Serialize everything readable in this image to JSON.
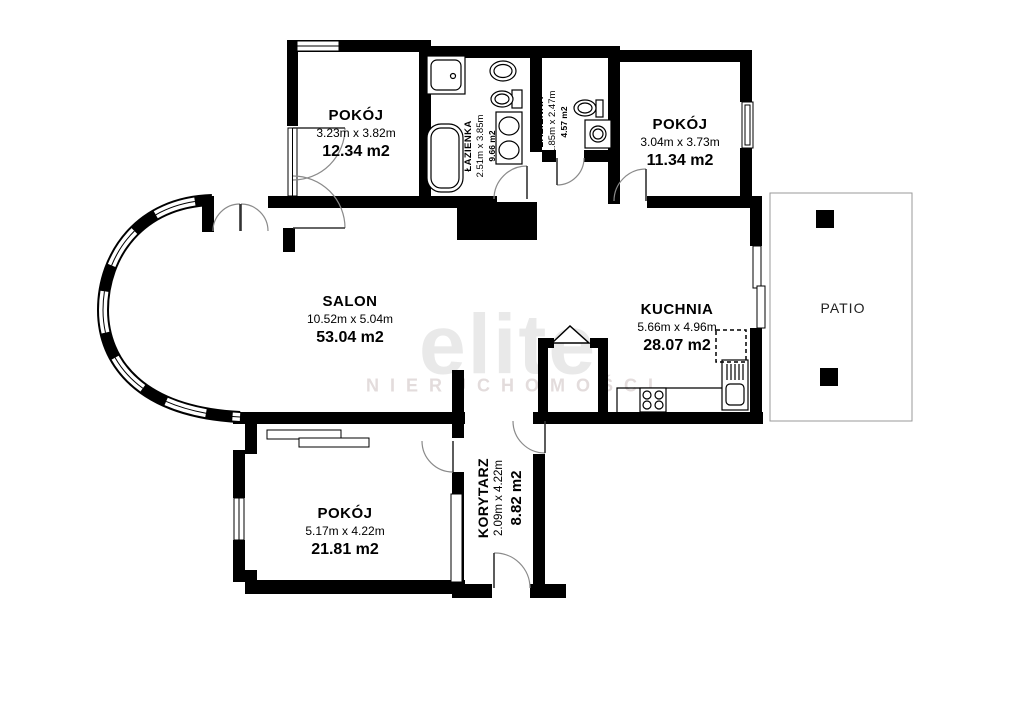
{
  "plan": {
    "rooms": [
      {
        "id": "room-top-left",
        "name": "POKÓJ",
        "dims": "3.23m x 3.82m",
        "area": "12.34 m2"
      },
      {
        "id": "bathroom-1",
        "name": "ŁAZIENKA",
        "dims": "2.51m x 3.85m",
        "area": "9.66 m2"
      },
      {
        "id": "bathroom-2",
        "name": "ŁAZIENKA",
        "dims": "1.85m x 2.47m",
        "area": "4.57 m2"
      },
      {
        "id": "room-top-right",
        "name": "POKÓJ",
        "dims": "3.04m x 3.73m",
        "area": "11.34 m2"
      },
      {
        "id": "salon",
        "name": "SALON",
        "dims": "10.52m x 5.04m",
        "area": "53.04 m2"
      },
      {
        "id": "kitchen",
        "name": "KUCHNIA",
        "dims": "5.66m x 4.96m",
        "area": "28.07 m2"
      },
      {
        "id": "corridor",
        "name": "KORYTARZ",
        "dims": "2.09m x 4.22m",
        "area": "8.82 m2"
      },
      {
        "id": "room-bottom",
        "name": "POKÓJ",
        "dims": "5.17m x 4.22m",
        "area": "21.81 m2"
      },
      {
        "id": "patio",
        "name": "PATIO"
      }
    ],
    "watermark": {
      "brand": "elite",
      "subtitle": "NIERUCHOMOŚCI"
    },
    "colors": {
      "wall": "#000000",
      "watermark": "#e9e9e9",
      "patio_border": "#999999"
    }
  }
}
